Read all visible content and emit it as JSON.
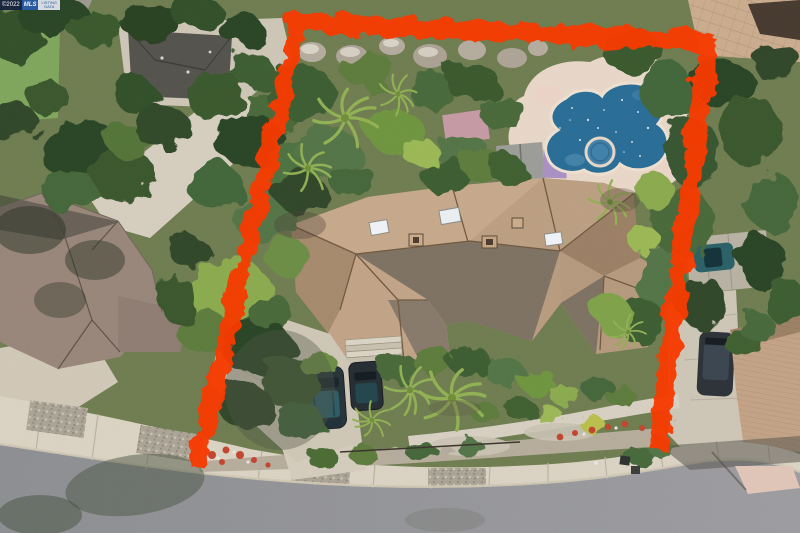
{
  "watermark": {
    "segments": [
      {
        "text": "©2022"
      },
      {
        "text": "MLS"
      },
      {
        "text": "LISTING"
      },
      {
        "text": "DATA"
      }
    ]
  },
  "scene": {
    "type": "aerial-drone-photo",
    "subject": "Single-family home with tile roof, freeform swimming pool and spa, tropical landscaping, marked with a red property-boundary overlay open toward the street frontage"
  },
  "colors": {
    "boundary_red": "#f63b00",
    "pool_water": "#2a6b94",
    "spa_water": "#3f7fa8",
    "pool_deck": "#e7d6c6",
    "roof_tan": "#b79a7d",
    "roof_tan_light": "#c8aa8c",
    "roof_tan_dark": "#6f675c",
    "roof_left_neighbor": "#968478",
    "roof_right_neighbor": "#c2a184",
    "street_asphalt": "#919195",
    "sidewalk_concrete": "#d9d1c1",
    "driveway_concrete": "#cdc5b4",
    "lawn_green": "#7da45c",
    "tree_dark_green": "#31482a",
    "tree_bright_green": "#8fae52",
    "car_teal": "#2b5f66",
    "suv_dark": "#2d3338",
    "shed_gray": "#9a9a96",
    "awning_purple": "#a78fc2",
    "canopy_pink": "#c99aa8",
    "building_gray": "#54524c"
  }
}
